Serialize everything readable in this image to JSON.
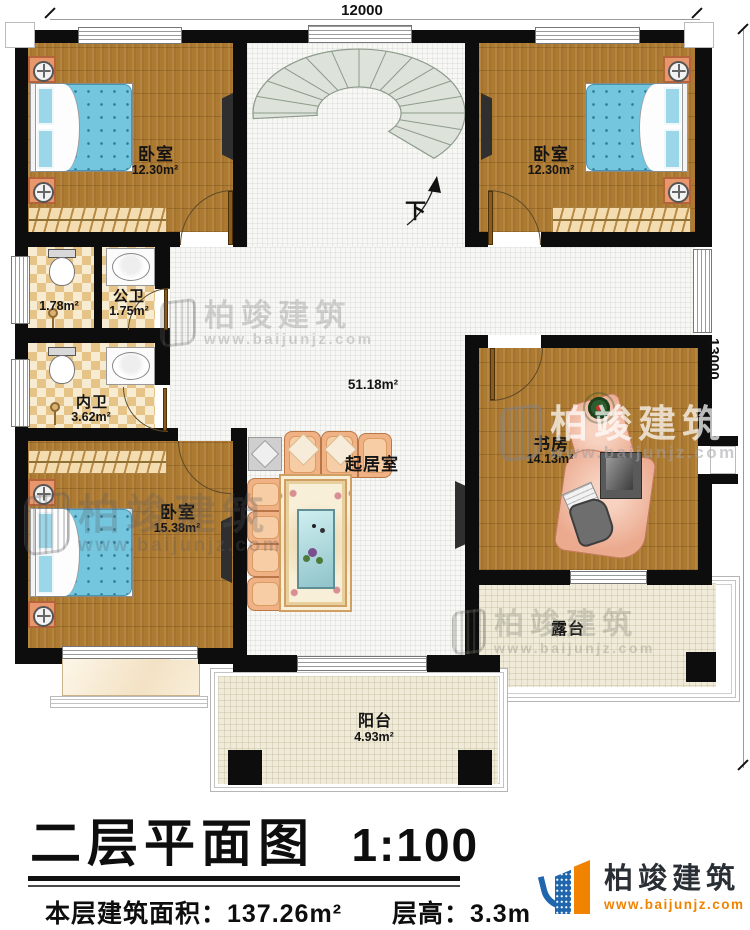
{
  "dimensions": {
    "top": "12000",
    "right": "13000"
  },
  "stairs": {
    "down": "下"
  },
  "rooms": {
    "bedroom_tl": {
      "name": "卧室",
      "area": "12.30m²"
    },
    "bedroom_tr": {
      "name": "卧室",
      "area": "12.30m²"
    },
    "shower_room": {
      "area": "1.78m²"
    },
    "public_bath": {
      "name": "公卫",
      "area": "1.75m²"
    },
    "ensuite_bath": {
      "name": "内卫",
      "area": "3.62m²"
    },
    "bedroom_bl": {
      "name": "卧室",
      "area": "15.38m²"
    },
    "living_room": {
      "name": "起居室",
      "area": "51.18m²"
    },
    "study": {
      "name": "书房",
      "area": "14.13m²"
    },
    "terrace": {
      "name": "露台"
    },
    "balcony": {
      "name": "阳台",
      "area": "4.93m²"
    }
  },
  "title_block": {
    "title": "二层平面图",
    "scale": "1:100",
    "floor_area": "本层建筑面积：137.26m²",
    "floor_height": "层高：3.3m"
  },
  "logo": {
    "name": "柏竣建筑",
    "website": "www.baijunjz.com"
  },
  "watermark": {
    "name": "柏竣建筑",
    "website": "www.baijunjz.com"
  },
  "colors": {
    "wall": "#0d0d0d",
    "wood": "#ad7a31",
    "tile_dark": "#e6c386",
    "tile_light": "#f7ecd2",
    "bed_blue": "#74c6de",
    "sofa": "#f0b184",
    "desk": "#eba98e",
    "outdoor": "#f0ebd8",
    "stair": "#dde3da",
    "accent": "#f08300",
    "accent_furn": "#e8966b",
    "logo_blue": "#1f66ad"
  }
}
